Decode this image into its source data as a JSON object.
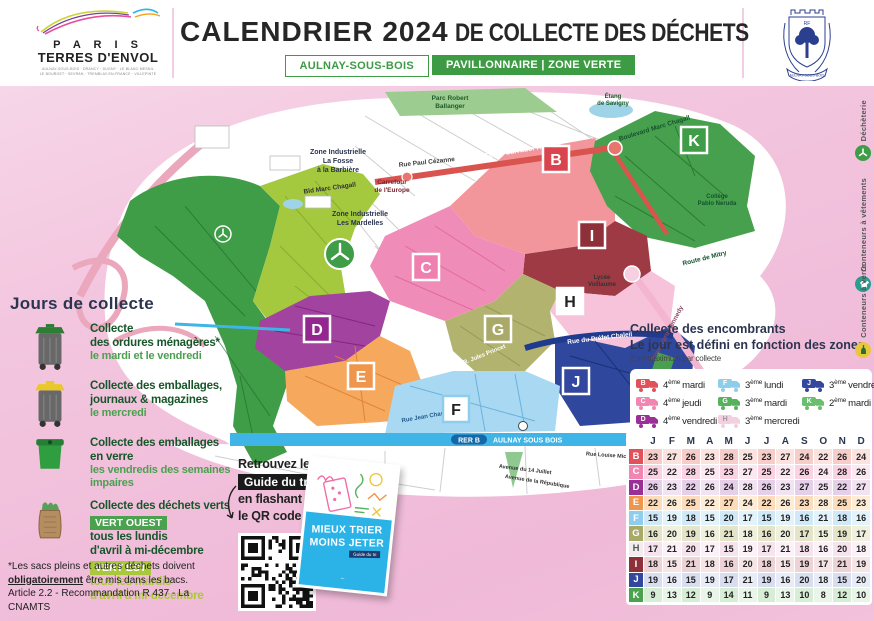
{
  "header": {
    "logo_line1": "P A R I S",
    "logo_line2": "TERRES D'ENVOL",
    "logo_communes1": "AULNAY-SOUS-BOIS · DRANCY · DUGNY · LE BLANC-MESNIL",
    "logo_communes2": "LE BOURGET · SEVRAN · TREMBLAY-EN-FRANCE · VILLEPINTE",
    "title_main": "CALENDRIER 2024",
    "title_rest": "DE COLLECTE DES DÉCHETS",
    "badge_city": "AULNAY-SOUS-BOIS",
    "badge_zone": "PAVILLONNAIRE | ZONE VERTE",
    "crest_banner": "AULNAY-SOUS-BOIS"
  },
  "sidebar": {
    "title": "Jours de collecte",
    "items": [
      {
        "title1": "Collecte",
        "title2": "des ordures ménagères*",
        "days": "le mardi et le vendredi"
      },
      {
        "title1": "Collecte des emballages,",
        "title2": "journaux & magazines",
        "days": "le mercredi"
      },
      {
        "title1": "Collecte des emballages en verre",
        "days": "les vendredis des semaines impaires"
      },
      {
        "title1": "Collecte des déchets verts",
        "badge_west": "VERT OUEST",
        "west_line1": "tous les lundis",
        "west_line2": "d'avril à mi-décembre",
        "badge_east": "VERT EST",
        "east_line1": "tous les mardis",
        "east_line2": "d'avril à mi-décembre"
      }
    ],
    "footnote1": "*Les sacs pleins et autres déchets doivent",
    "footnote2_u": "obligatoirement",
    "footnote2_rest": " être mis dans les bacs.",
    "footnote3": "Article 2.2 - Recommandation R 437 - La CNAMTS"
  },
  "map": {
    "zone_letters": [
      "B",
      "C",
      "D",
      "E",
      "F",
      "G",
      "H",
      "I",
      "J",
      "K"
    ],
    "labels": [
      "Parc Robert",
      "Ballanger",
      "Zone Industrielle",
      "La Fosse",
      "à la Barbière",
      "Zone Industrielle",
      "Les Mardelles",
      "Bld Marc Chagall",
      "Rue Paul Cézanne",
      "Carrefour",
      "de l'Europe",
      "Cours Salvador Allende",
      "Boulevard Marc Chagall",
      "Étang",
      "de Savigny",
      "Collège",
      "Pablo Neruda",
      "Route de Mitry",
      "Boulevard Kennedy",
      "Lycée",
      "Voillaume",
      "Rue du Préfet Chaleil",
      "RER B",
      "AULNAY SOUS BOIS",
      "Rue Louise Michel",
      "Avenue du 14 Juillet",
      "Avenue de la République",
      "Bd de Gourgues",
      "Rue Jean Charcot",
      "R. Jules Princet"
    ]
  },
  "encombrants": {
    "title1": "Collecte des encombrants",
    "title2": "Le jour est défini en fonction des zones",
    "subtitle": "2 m³ maximum par collecte",
    "sup": "ème",
    "legend": [
      {
        "zone": "B",
        "num": "4",
        "day": "mardi",
        "color": "#e0515a",
        "text_color": "#ffffff"
      },
      {
        "zone": "C",
        "num": "4",
        "day": "jeudi",
        "color": "#f285b2",
        "text_color": "#ffffff"
      },
      {
        "zone": "D",
        "num": "4",
        "day": "vendredi",
        "color": "#9a3096",
        "text_color": "#ffffff"
      },
      {
        "zone": "E",
        "num": "4",
        "day": "lundi",
        "color": "#f0954c",
        "text_color": "#ffffff"
      },
      {
        "zone": "F",
        "num": "3",
        "day": "lundi",
        "color": "#8ecdec",
        "text_color": "#ffffff"
      },
      {
        "zone": "G",
        "num": "3",
        "day": "mardi",
        "color": "#57b25e",
        "text_color": "#ffffff"
      },
      {
        "zone": "H",
        "num": "3",
        "day": "mercredi",
        "color": "#f3cfe0",
        "text_color": "#999999"
      },
      {
        "zone": "I",
        "num": "3",
        "day": "jeudi",
        "color": "#8e3039",
        "text_color": "#ffffff"
      },
      {
        "zone": "J",
        "num": "3",
        "day": "vendredi",
        "color": "#33479f",
        "text_color": "#ffffff"
      },
      {
        "zone": "K",
        "num": "2",
        "day": "mardi",
        "color": "#6abf6e",
        "text_color": "#ffffff"
      }
    ]
  },
  "calendar": {
    "months": [
      "J",
      "F",
      "M",
      "A",
      "M",
      "J",
      "J",
      "A",
      "S",
      "O",
      "N",
      "D"
    ],
    "rows": [
      {
        "zone": "B",
        "color": "#e0515a",
        "letter_color": "#ffffff",
        "tintA": "#f6cdc9",
        "tintB": "#fbe3e0",
        "values": [
          23,
          27,
          26,
          23,
          28,
          25,
          23,
          27,
          24,
          22,
          26,
          24
        ]
      },
      {
        "zone": "C",
        "color": "#f285b2",
        "letter_color": "#ffffff",
        "tintA": "#fad2e4",
        "tintB": "#fde7f1",
        "values": [
          25,
          22,
          28,
          25,
          23,
          27,
          25,
          22,
          26,
          24,
          28,
          26
        ]
      },
      {
        "zone": "D",
        "color": "#9a3096",
        "letter_color": "#ffffff",
        "tintA": "#e6cfe8",
        "tintB": "#f2e3f3",
        "values": [
          26,
          23,
          22,
          26,
          24,
          28,
          26,
          23,
          27,
          25,
          22,
          27
        ]
      },
      {
        "zone": "E",
        "color": "#f0954c",
        "letter_color": "#ffffff",
        "tintA": "#fcdcba",
        "tintB": "#fdecd6",
        "values": [
          22,
          26,
          25,
          22,
          27,
          24,
          22,
          26,
          23,
          28,
          25,
          23
        ]
      },
      {
        "zone": "F",
        "color": "#8ecdec",
        "letter_color": "#ffffff",
        "tintA": "#cfe9f8",
        "tintB": "#e3f3fb",
        "values": [
          15,
          19,
          18,
          15,
          20,
          17,
          15,
          19,
          16,
          21,
          18,
          16
        ]
      },
      {
        "zone": "G",
        "color": "#a9aa69",
        "letter_color": "#ffffff",
        "tintA": "#e4e4c9",
        "tintB": "#f0f0de",
        "values": [
          16,
          20,
          19,
          16,
          21,
          18,
          16,
          20,
          17,
          15,
          19,
          17
        ]
      },
      {
        "zone": "H",
        "color": "#f2ecef",
        "letter_color": "#555555",
        "tintA": "#f6e3ed",
        "tintB": "#fbf1f6",
        "values": [
          17,
          21,
          20,
          17,
          15,
          19,
          17,
          21,
          18,
          16,
          20,
          18
        ]
      },
      {
        "zone": "I",
        "color": "#8e3039",
        "letter_color": "#ffffff",
        "tintA": "#eed3d6",
        "tintB": "#f6e5e7",
        "values": [
          18,
          15,
          21,
          18,
          16,
          20,
          18,
          15,
          19,
          17,
          21,
          19
        ]
      },
      {
        "zone": "J",
        "color": "#33479f",
        "letter_color": "#ffffff",
        "tintA": "#d8def0",
        "tintB": "#e8ecf7",
        "values": [
          19,
          16,
          15,
          19,
          17,
          21,
          19,
          16,
          20,
          18,
          15,
          20
        ]
      },
      {
        "zone": "K",
        "color": "#4aa24e",
        "letter_color": "#ffffff",
        "tintA": "#d8edd6",
        "tintB": "#e9f5e8",
        "values": [
          9,
          13,
          12,
          9,
          14,
          11,
          9,
          13,
          10,
          8,
          12,
          10
        ]
      }
    ]
  },
  "qr_section": {
    "line1": "Retrouvez le",
    "badge": "Guide du tri",
    "line2": "en flashant",
    "line3": "le QR code"
  },
  "booklet": {
    "title1": "MIEUX TRIER",
    "title2": "MOINS JETER",
    "badge": "Guide du tri",
    "logo": "~"
  },
  "right_rail": [
    {
      "label": "Déchèterie",
      "color": "#3f9c47"
    },
    {
      "label": "Conteneurs à vêtements",
      "color": "#2a9d8f"
    },
    {
      "label": "Conteneurs à verre",
      "color": "#e9c73d"
    }
  ]
}
